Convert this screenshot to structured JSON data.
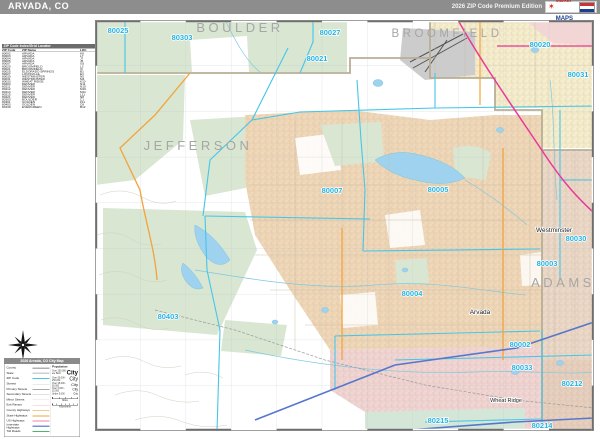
{
  "header": {
    "title": "ARVADA, CO",
    "edition": "2026 ZIP Code Premium Edition",
    "logo": {
      "line1": "Market",
      "line2": "MAPS",
      "star": "✶"
    }
  },
  "zip_table": {
    "title": "ZIP Code Index/Grid Locator",
    "columns": [
      "ZIP Code",
      "ZIP Name",
      "LOC"
    ],
    "rows": [
      [
        "80002",
        "ARVADA",
        "K8"
      ],
      [
        "80003",
        "ARVADA",
        "L7"
      ],
      [
        "80004",
        "ARVADA",
        "J7"
      ],
      [
        "80005",
        "ARVADA",
        "J5"
      ],
      [
        "80007",
        "ARVADA",
        "G5"
      ],
      [
        "80020",
        "BROOMFIELD",
        "L2"
      ],
      [
        "80021",
        "BROOMFIELD",
        "I3"
      ],
      [
        "80025",
        "ELDORADO SPRINGS",
        "B1"
      ],
      [
        "80027",
        "LOUISVILLE",
        "E1"
      ],
      [
        "80030",
        "WESTMINSTER",
        "N5"
      ],
      [
        "80031",
        "WESTMINSTER",
        "M4"
      ],
      [
        "80033",
        "WHEAT RIDGE",
        "K10"
      ],
      [
        "80204",
        "DENVER",
        "N11"
      ],
      [
        "80211",
        "DENVER",
        "N10"
      ],
      [
        "80212",
        "DENVER",
        "M10"
      ],
      [
        "80214",
        "DENVER",
        "M11"
      ],
      [
        "80215",
        "DENVER",
        "L11"
      ],
      [
        "80221",
        "DENVER",
        "N8"
      ],
      [
        "80303",
        "BOULDER",
        "C1"
      ],
      [
        "80401",
        "GOLDEN",
        "F11"
      ],
      [
        "80403",
        "GOLDEN",
        "C8"
      ],
      [
        "80439",
        "EVERGREEN",
        "B12"
      ]
    ]
  },
  "legend": {
    "title": "2026 Arvada, CO City Map",
    "rows": [
      {
        "label": "County",
        "style": "county"
      },
      {
        "label": "State",
        "style": "state"
      },
      {
        "label": "ZIP Code",
        "style": "zip"
      },
      {
        "label": "Streets",
        "style": "streets"
      },
      {
        "label": "Primary Streets",
        "style": "primary"
      },
      {
        "label": "Secondary Streets",
        "style": "secondary"
      },
      {
        "label": "Minor Streets",
        "style": "minor"
      },
      {
        "label": "Exit Ramps",
        "style": "ramps"
      },
      {
        "label": "County Highways",
        "style": "cohwy"
      },
      {
        "label": "State Highways",
        "style": "sthwy"
      },
      {
        "label": "US Highways",
        "style": "ushwy"
      },
      {
        "label": "Interstate Highways",
        "style": "ihwy"
      },
      {
        "label": "Toll Roads",
        "style": "toll"
      }
    ],
    "population": {
      "title": "Population",
      "entries": [
        {
          "label": "Over 250,000 are Bold",
          "sample": "City",
          "size": "xl"
        },
        {
          "label": "Over 50,000 - 250,000",
          "sample": "City",
          "size": "lg"
        },
        {
          "label": "Over 25,000 - 50,000",
          "sample": "City",
          "size": "md"
        },
        {
          "label": "Over 5,000 - 25,000",
          "sample": "City",
          "size": "sm"
        },
        {
          "label": "Under 5,000",
          "sample": "City",
          "size": "xs"
        }
      ]
    },
    "scale": {
      "miles": "Miles",
      "kilometers": "Kilometers"
    }
  },
  "map": {
    "counties": [
      {
        "text": "BOULDER"
      },
      {
        "text": "BROOMFIELD"
      },
      {
        "text": "JEFFERSON"
      },
      {
        "text": "ADAMS"
      }
    ],
    "cities": [
      {
        "text": "Westminster"
      },
      {
        "text": "Arvada"
      },
      {
        "text": "Wheat Ridge"
      }
    ],
    "zips": [
      {
        "text": "80025"
      },
      {
        "text": "80303"
      },
      {
        "text": "80027"
      },
      {
        "text": "80021"
      },
      {
        "text": "80020"
      },
      {
        "text": "80031"
      },
      {
        "text": "80007"
      },
      {
        "text": "80005"
      },
      {
        "text": "80004"
      },
      {
        "text": "80403"
      },
      {
        "text": "80030"
      },
      {
        "text": "80003"
      },
      {
        "text": "80002"
      },
      {
        "text": "80033"
      },
      {
        "text": "80212"
      },
      {
        "text": "80214"
      },
      {
        "text": "80215"
      }
    ],
    "colors": {
      "zip_label": "#25b2e0",
      "county_label": "#a6a6a6",
      "park_green": "#d9e6d2",
      "urban_tan": "#f0d8ba",
      "urban_yellow": "#f6efcf",
      "urban_pink": "#f2d6d6",
      "urban_mauve": "#ecd9c9",
      "lake_blue": "#9fd2ee",
      "hwy_orange": "#f2a33c",
      "hwy_magenta": "#e83a98",
      "hwy_blue": "#5577cc"
    }
  }
}
